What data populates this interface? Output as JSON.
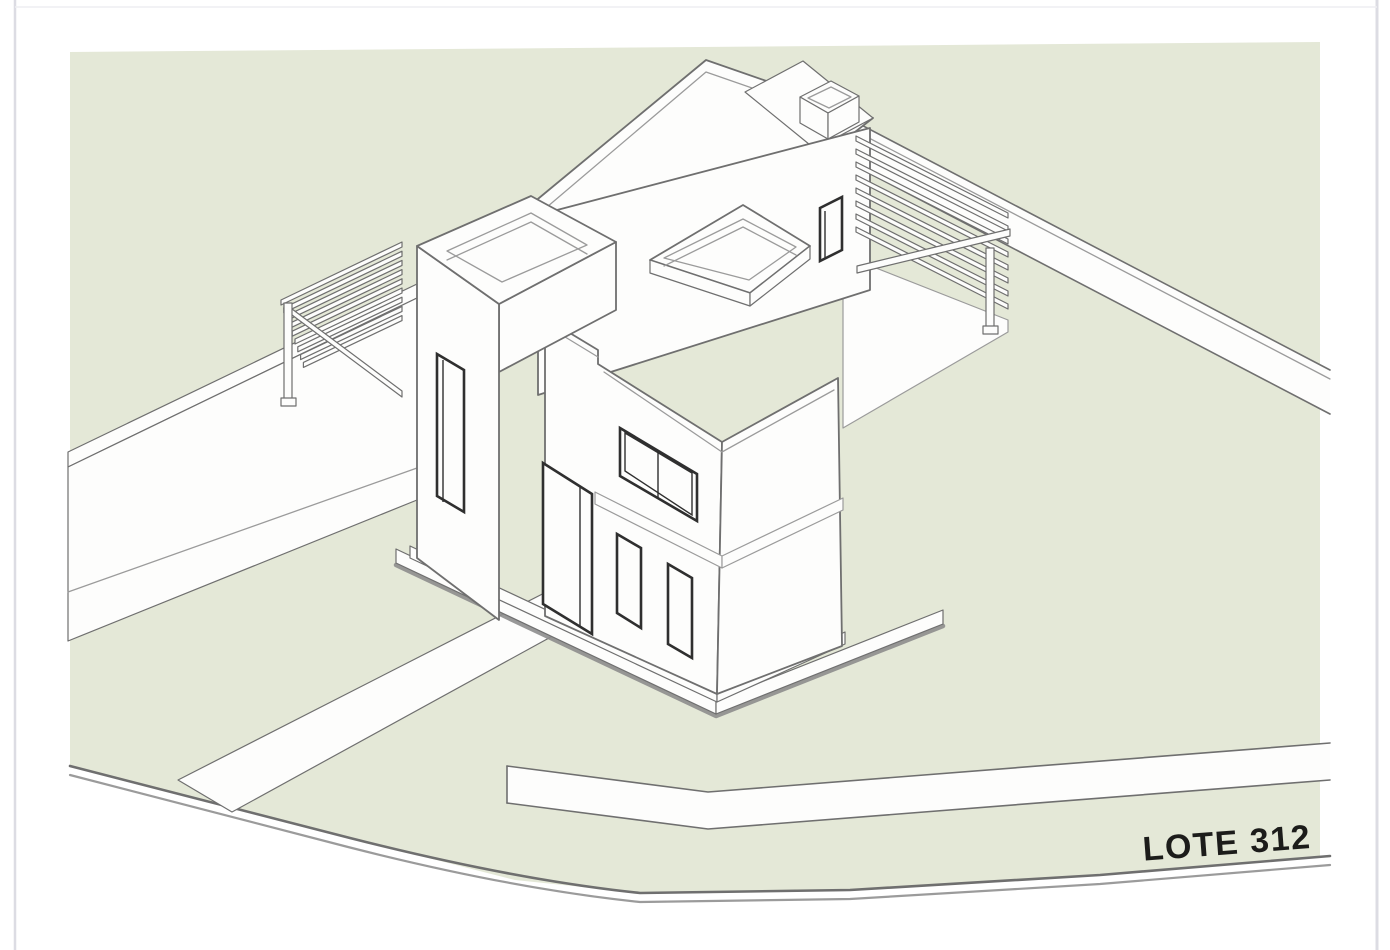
{
  "page": {
    "kind": "architectural-site-plan-rendering",
    "background": "#ffffff"
  },
  "label": {
    "text": "LOTE 312",
    "color": "#1c1c1a",
    "font_size_px": 34,
    "rotation_deg": -4.3
  },
  "colors": {
    "page_bg": "#ffffff",
    "lot_fill": "#e4e8d7",
    "white_fill": "#fdfdfc",
    "line": "#6f6f6f",
    "line_light": "#9b9b9b",
    "line_dark": "#2f2f2f",
    "shadow": "#8d8d8d",
    "frame_line": "#dcdce3",
    "label_color": "#1c1c1a"
  },
  "scene": {
    "lot_shape": "irregular corner lot, streets on lower-left and bottom edges",
    "house": "modern flat-roof two-story house with stair tower, roof-terrace parapets and two slatted pergolas"
  }
}
